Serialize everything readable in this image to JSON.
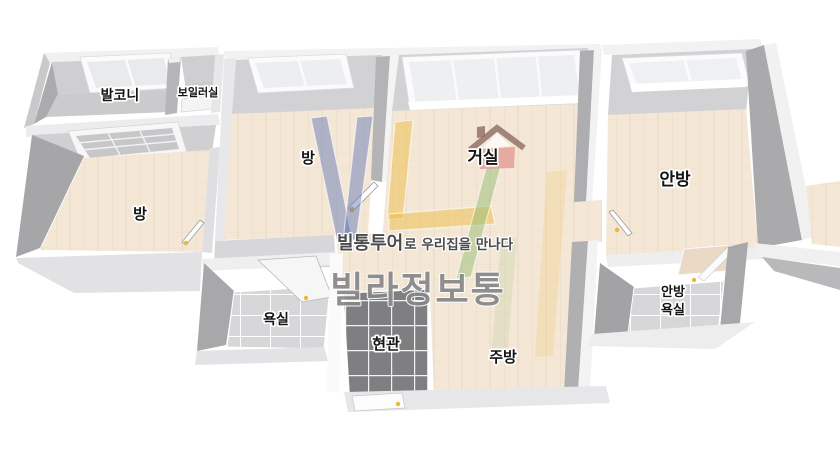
{
  "floorplan": {
    "rooms": [
      {
        "id": "balcony",
        "label": "발코니"
      },
      {
        "id": "boiler-room",
        "label": "보일러실"
      },
      {
        "id": "bedroom-left",
        "label": "방"
      },
      {
        "id": "bedroom-middle",
        "label": "방"
      },
      {
        "id": "living-room",
        "label": "거실"
      },
      {
        "id": "master-bedroom",
        "label": "안방"
      },
      {
        "id": "bathroom",
        "label": "욕실"
      },
      {
        "id": "entrance",
        "label": "현관"
      },
      {
        "id": "kitchen",
        "label": "주방"
      },
      {
        "id": "master-bathroom",
        "label_line1": "안방",
        "label_line2": "욕실"
      }
    ]
  },
  "watermark": {
    "tagline_brand": "빌통투어",
    "tagline_rest": "로 우리집을 만나다",
    "brand": "빌라정보통",
    "logo": {
      "v_color": "#4f68b0",
      "l_color": "#ecbc45",
      "slash_color": "#93bd72",
      "house_color": "#e29b92"
    }
  },
  "colors": {
    "background": "#ffffff",
    "wood_floor": "#f4e7d6",
    "wall_top": "#f1f1f2",
    "wall_face_dark": "#a8a8ab",
    "wall_face_mid": "#b4b4b7",
    "wall_face_back": "#d2d2d4",
    "balcony_floor": "#cbcbce",
    "tile_light": "#d7d7d9",
    "tile_dark": "#7f7f82",
    "door_marker": "#e9b83d",
    "label_text": "#141414",
    "brand_text": "#87878a",
    "tagline_text": "#4b4b4d"
  }
}
